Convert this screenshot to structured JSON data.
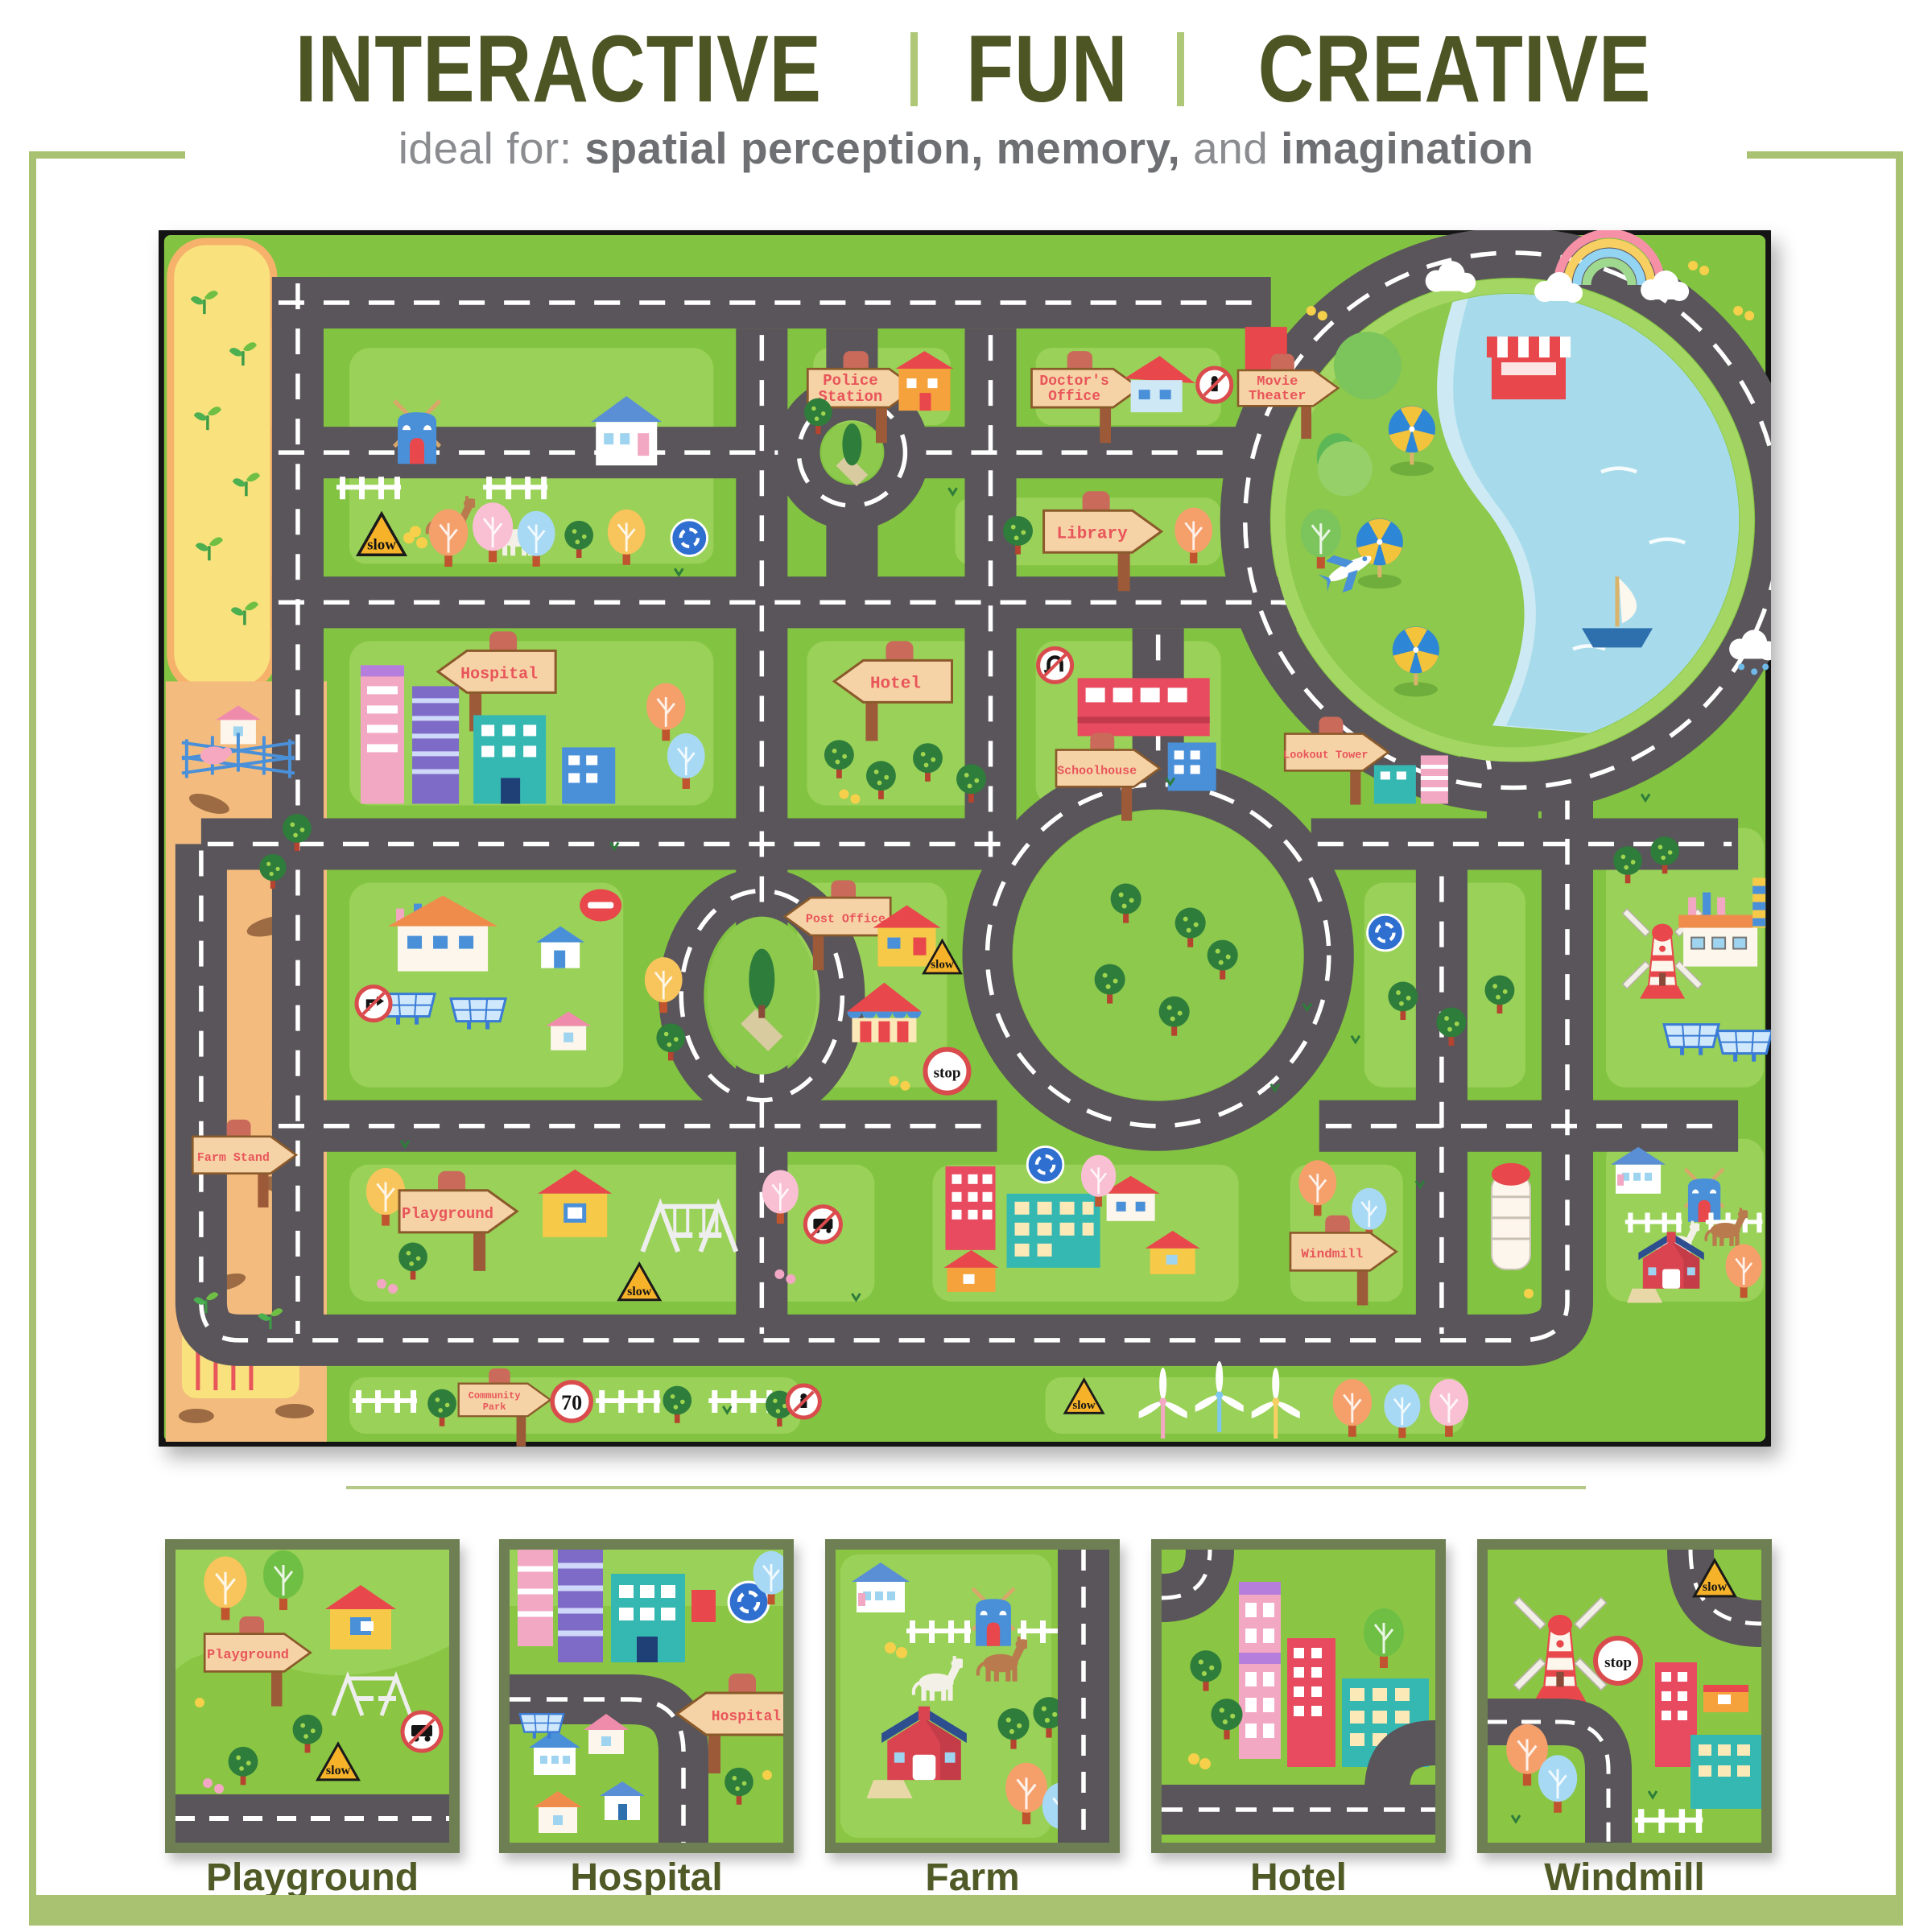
{
  "header": {
    "words": [
      "INTERACTIVE",
      "FUN",
      "CREATIVE"
    ],
    "separator": "|"
  },
  "subtitle": {
    "prefix": "ideal for: ",
    "seg1": "spatial perception,",
    "mid": " ",
    "seg2": "memory,",
    "and_word": " and ",
    "seg3": "imagination"
  },
  "mat": {
    "signs": {
      "police1": "Police",
      "police2": "Station",
      "doctor1": "Doctor's",
      "doctor2": "Office",
      "movie1": "Movie",
      "movie2": "Theater",
      "library": "Library",
      "hotel": "Hotel",
      "hospital": "Hospital",
      "lookout": "Lookout Tower",
      "post": "Post Office",
      "school": "Schoolhouse",
      "playground": "Playground",
      "farmstand": "Farm Stand",
      "community1": "Community",
      "community2": "Park",
      "windmill": "Windmill"
    },
    "road_signs": {
      "slow": "slow",
      "stop": "stop",
      "speed_limit": "70"
    }
  },
  "thumbnails": [
    {
      "label": "Playground"
    },
    {
      "label": "Hospital"
    },
    {
      "label": "Farm"
    },
    {
      "label": "Hotel"
    },
    {
      "label": "Windmill"
    }
  ],
  "colors": {
    "accent_olive": "#4d5524",
    "light_green_frame": "#a9c271",
    "subtitle_gray": "#6d6f72",
    "mat_grass": "#82c341",
    "grass_light": "#9ad158",
    "road_gray": "#59555a",
    "lake_blue": "#a7dbeb",
    "sign_board_tan": "#f6d3a7",
    "sign_text_red": "#e8555a",
    "farm_strip_yellow": "#f9e27e",
    "dirt_orange": "#f3bc7e"
  }
}
